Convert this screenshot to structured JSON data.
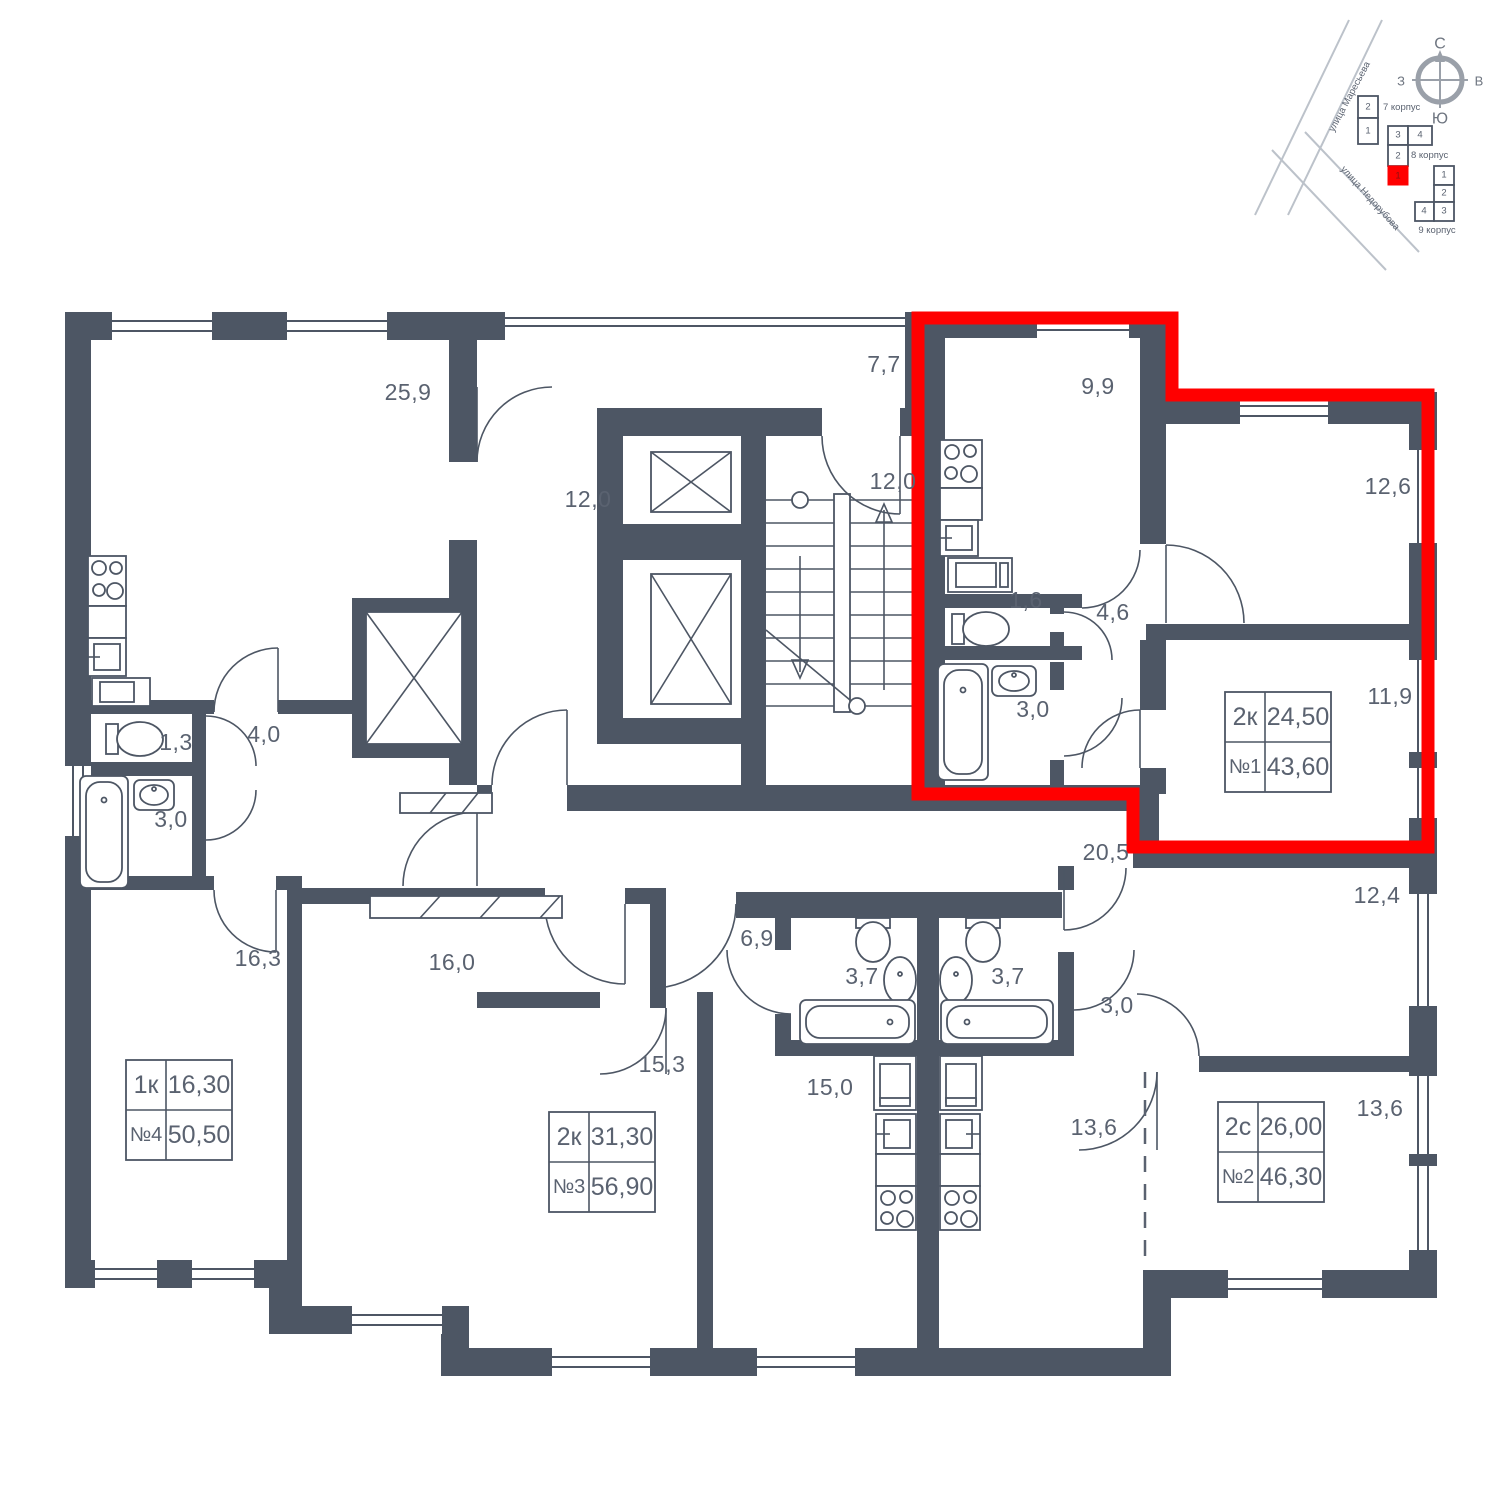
{
  "floor_plan": {
    "wall_color": "#4d5664",
    "highlight_color": "#ff0000",
    "rooms": [
      {
        "area": "25,9"
      },
      {
        "area": "12,0"
      },
      {
        "area": "7,7"
      },
      {
        "area": "12,0"
      },
      {
        "area": "9,9"
      },
      {
        "area": "12,6"
      },
      {
        "area": "1,6"
      },
      {
        "area": "4,6"
      },
      {
        "area": "3,0"
      },
      {
        "area": "11,9"
      },
      {
        "area": "1,3"
      },
      {
        "area": "4,0"
      },
      {
        "area": "3,0"
      },
      {
        "area": "16,3"
      },
      {
        "area": "16,0"
      },
      {
        "area": "6,9"
      },
      {
        "area": "3,7"
      },
      {
        "area": "3,7"
      },
      {
        "area": "20,5"
      },
      {
        "area": "12,4"
      },
      {
        "area": "3,0"
      },
      {
        "area": "15,3"
      },
      {
        "area": "15,0"
      },
      {
        "area": "13,6"
      },
      {
        "area": "13,6"
      }
    ],
    "apartments": [
      {
        "type": "2к",
        "rooms_area": "24,50",
        "number": "№1",
        "total_area": "43,60",
        "highlighted": true
      },
      {
        "type": "2с",
        "rooms_area": "26,00",
        "number": "№2",
        "total_area": "46,30",
        "highlighted": false
      },
      {
        "type": "2к",
        "rooms_area": "31,30",
        "number": "№3",
        "total_area": "56,90",
        "highlighted": false
      },
      {
        "type": "1к",
        "rooms_area": "16,30",
        "number": "№4",
        "total_area": "50,50",
        "highlighted": false
      }
    ]
  },
  "site_plan": {
    "streets": [
      {
        "name": "улица Маресьева"
      },
      {
        "name": "улица Недорубова"
      }
    ],
    "compass": {
      "north": "С",
      "east": "В",
      "south": "Ю",
      "west": "З"
    },
    "buildings": [
      {
        "name": "7 корпус",
        "sections": [
          "2",
          "1"
        ]
      },
      {
        "name": "8 корпус",
        "sections": [
          "3",
          "4",
          "2",
          "1"
        ],
        "current_section": "1"
      },
      {
        "name": "9 корпус",
        "sections": [
          "1",
          "2",
          "4",
          "3"
        ]
      }
    ]
  }
}
